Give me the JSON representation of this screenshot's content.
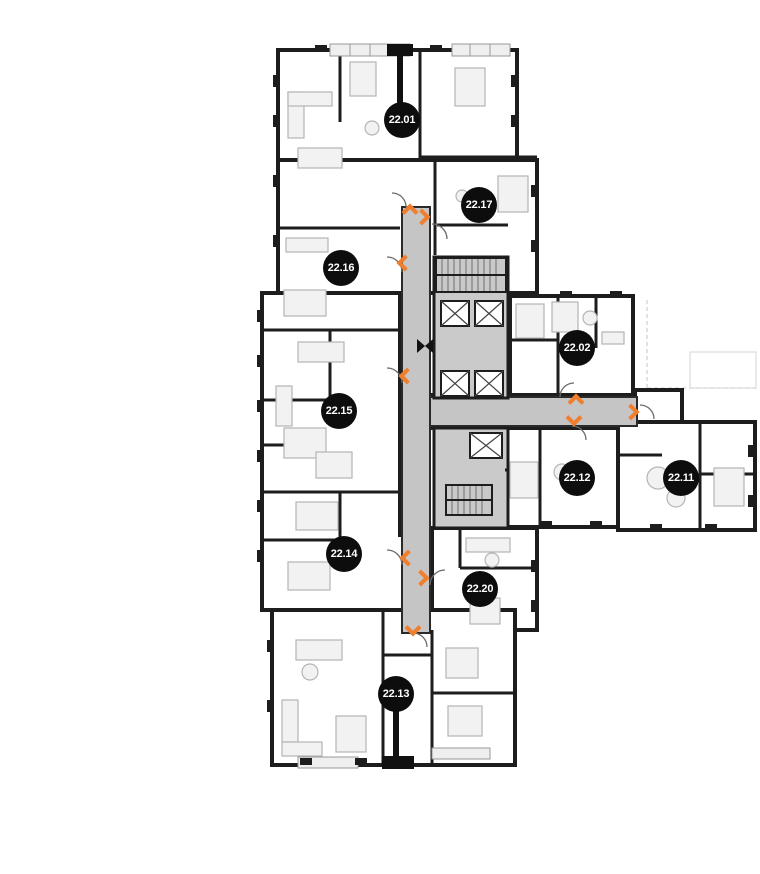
{
  "plan": {
    "floor_label": "22",
    "units": [
      {
        "id": "22.01",
        "x": 402,
        "y": 120
      },
      {
        "id": "22.17",
        "x": 479,
        "y": 205
      },
      {
        "id": "22.16",
        "x": 341,
        "y": 268
      },
      {
        "id": "22.02",
        "x": 577,
        "y": 348
      },
      {
        "id": "22.15",
        "x": 339,
        "y": 411
      },
      {
        "id": "22.12",
        "x": 577,
        "y": 478
      },
      {
        "id": "22.11",
        "x": 681,
        "y": 478
      },
      {
        "id": "22.14",
        "x": 344,
        "y": 554
      },
      {
        "id": "22.20",
        "x": 480,
        "y": 589
      },
      {
        "id": "22.13",
        "x": 396,
        "y": 694
      }
    ],
    "arrows": [
      {
        "dir": "up",
        "x": 410,
        "y": 212
      },
      {
        "dir": "right",
        "x": 422,
        "y": 217
      },
      {
        "dir": "left",
        "x": 405,
        "y": 263
      },
      {
        "dir": "left",
        "x": 407,
        "y": 376
      },
      {
        "dir": "up",
        "x": 576,
        "y": 402
      },
      {
        "dir": "down",
        "x": 574,
        "y": 418
      },
      {
        "dir": "right",
        "x": 631,
        "y": 412
      },
      {
        "dir": "left",
        "x": 408,
        "y": 558
      },
      {
        "dir": "right",
        "x": 421,
        "y": 578
      },
      {
        "dir": "down",
        "x": 413,
        "y": 628
      }
    ],
    "markers": [
      {
        "name": "section-cut-marker",
        "x": 425,
        "y": 346
      }
    ],
    "colors": {
      "badge": "#0d0d0d",
      "badge_text": "#ffffff",
      "arrow": "#ef7f2e",
      "corridor": "#c5c5c5",
      "core": "#cacaca",
      "wall": "#1d1d1d"
    }
  }
}
